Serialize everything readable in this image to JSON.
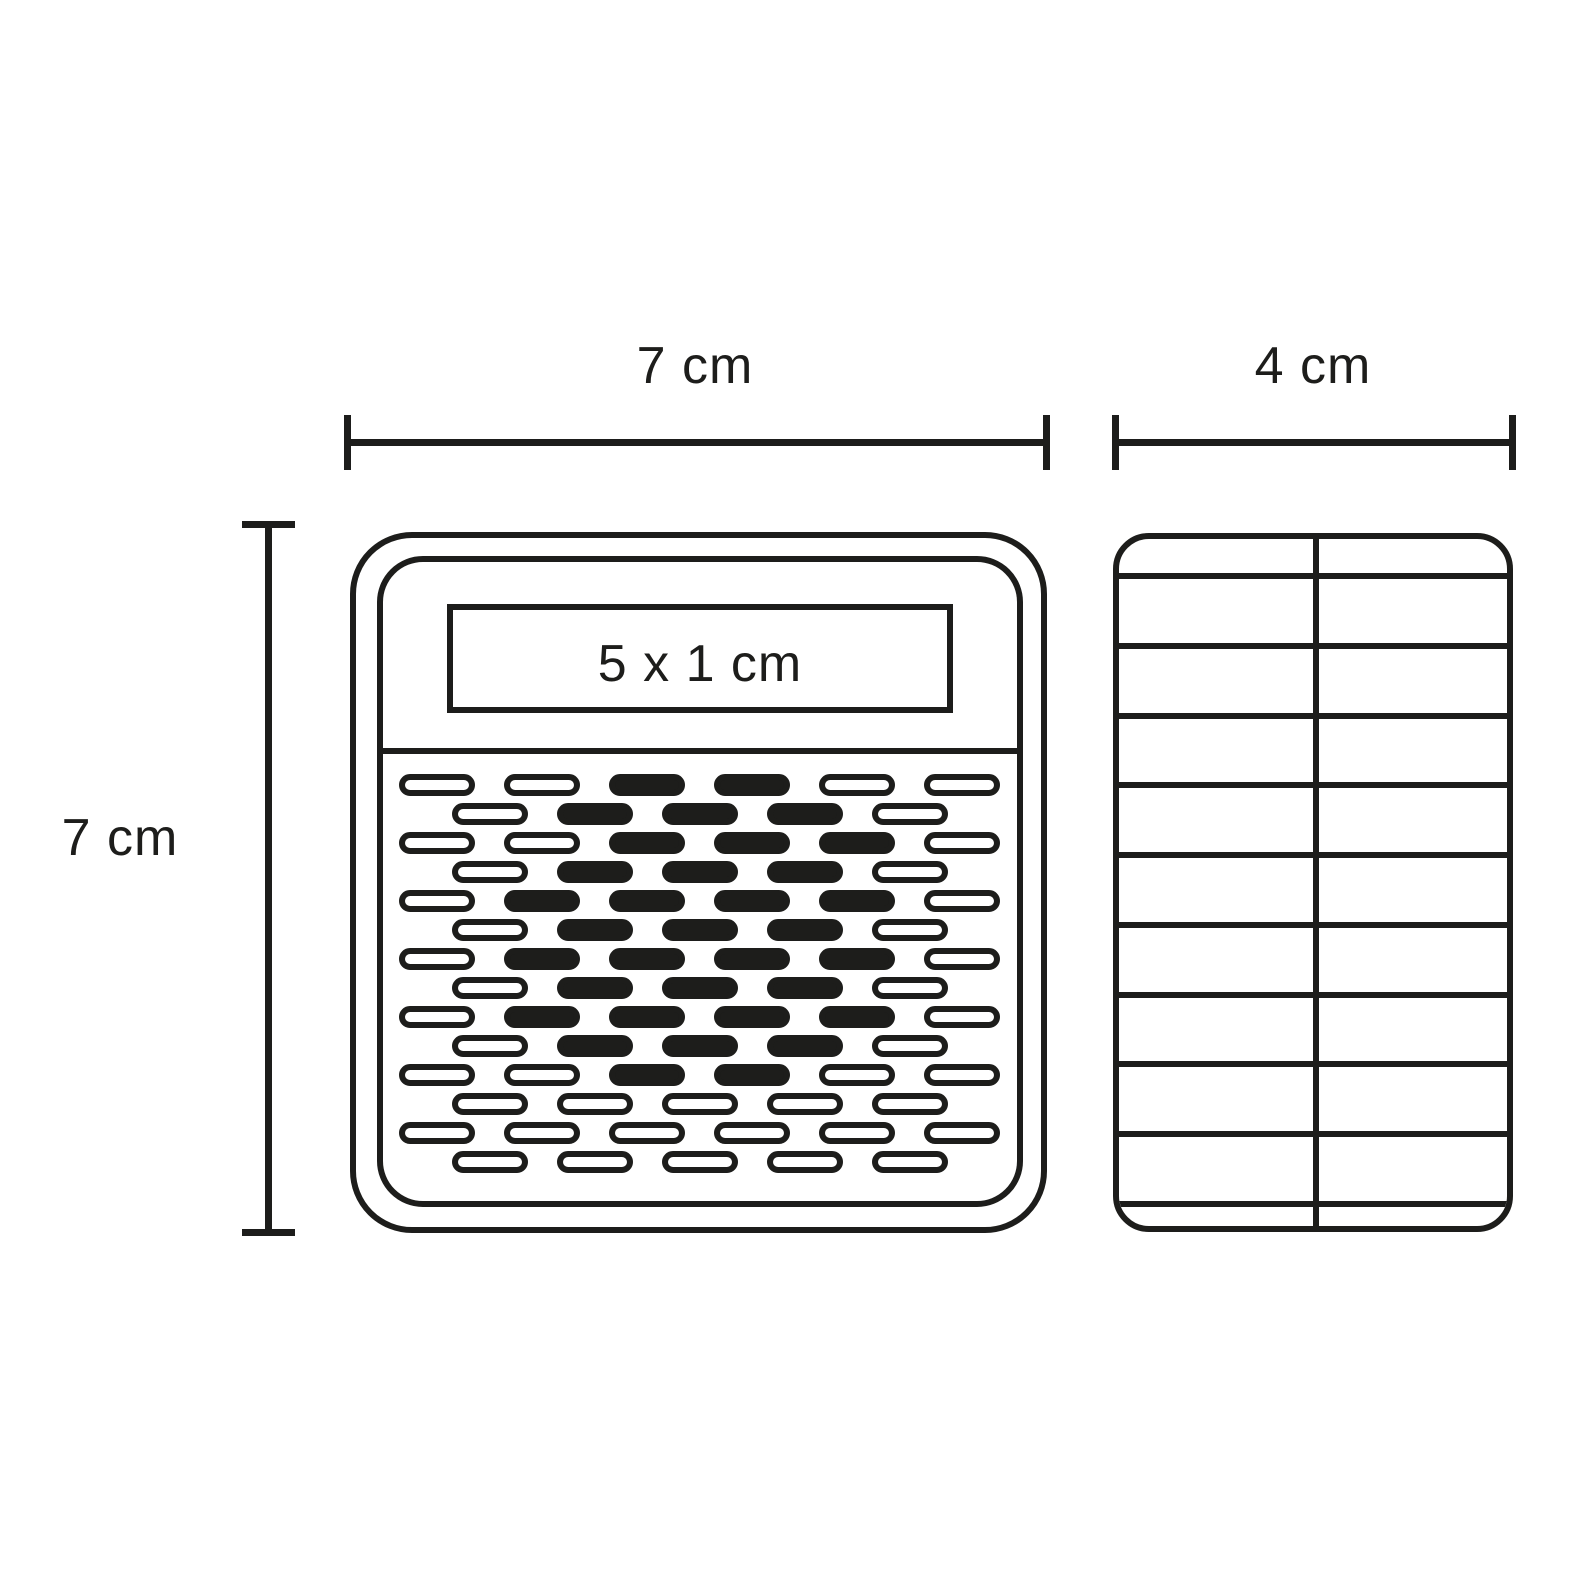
{
  "diagram": {
    "title": "device-dimension-diagram",
    "ink_color": "#1d1d1b",
    "background_color": "#ffffff",
    "dimensions": {
      "front_width_label": "7 cm",
      "front_height_label": "7 cm",
      "side_width_label": "4 cm",
      "display_size_label": "5 x 1 cm"
    },
    "front_view": {
      "shape": "rounded-square",
      "grille_pattern_legend": "W = outlined pill, B = filled pill; rows alternate 6 and 5 pills (staggered)",
      "grille_rows": [
        "WWBBWW",
        "WBBBW",
        "WWBBBW",
        "WBBBW",
        "WBBBBW",
        "WBBBW",
        "WBBBBW",
        "WBBBW",
        "WBBBBW",
        "WBBBW",
        "WWBBWW",
        "WWWWW",
        "WWWWWW",
        "WWWWW"
      ]
    },
    "side_view": {
      "shape": "rounded-rectangle",
      "bands": 11,
      "rib_line_offsets": [
        40,
        110,
        180,
        249,
        319,
        389,
        459,
        528,
        598,
        668
      ]
    }
  }
}
